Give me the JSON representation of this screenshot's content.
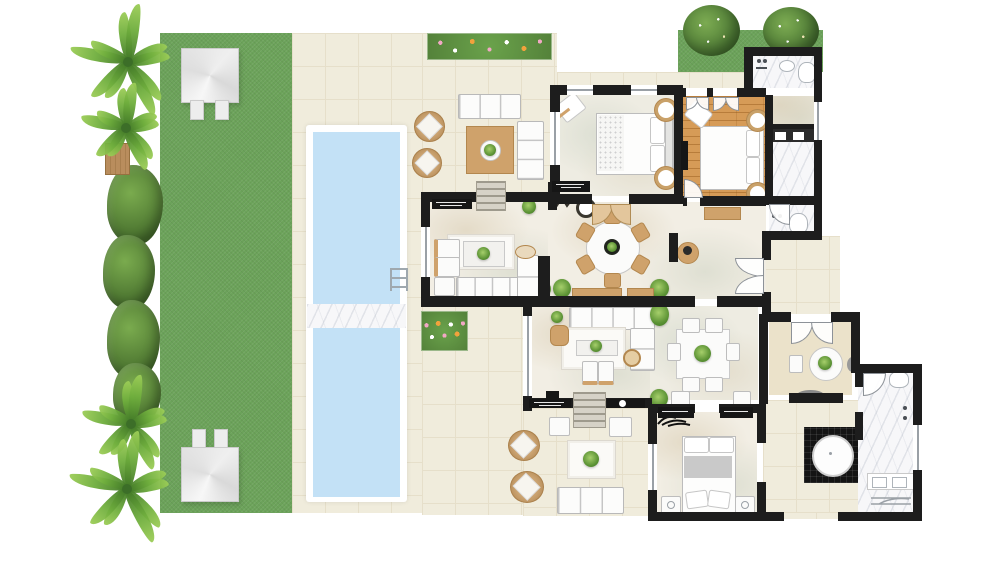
{
  "meta": {
    "kind": "villa floor plan",
    "view": "top-down 2D architectural plan",
    "visible_text": []
  },
  "palette": {
    "wall": "#1d1d1d",
    "lawn": "#6ca35a",
    "terrace": "#f0ecdc",
    "terrace_line": "#e6dfca",
    "interior": "#f2eee4",
    "interior_alt": "#eeece2",
    "wood_floor": "#d69b57",
    "marble": "#f7f7f9",
    "pool_water": "#c3e1f6",
    "tan": "#cfa26b",
    "tan_dark": "#b3874e",
    "white_furniture": "#fcfcfb",
    "furniture_line": "#b9b9b9",
    "black_furniture": "#161616",
    "steps": "#d6d2c7",
    "flower_pink": "#f2a8c5",
    "flower_orange": "#f2a23c",
    "glass_window": "#9aa0a6",
    "tub_black": "#141414"
  },
  "outdoor": {
    "garden": {
      "lawn": "large lawn along the left side",
      "palm_trees": 4,
      "hedge": "leafy hedge along left lawn edge",
      "bench": "wood slat bench on lawn edge",
      "gazebos": [
        {
          "position": "top-left"
        },
        {
          "position": "bottom-left"
        }
      ]
    },
    "pool": {
      "basins": 2,
      "divider": "marble bridge walkway",
      "ladder": "right edge of upper basin"
    },
    "terrace": {
      "flower_beds": 2,
      "upper_lounge": [
        "3-seat outdoor sofa",
        "2-seat outdoor sofa",
        "2 round rattan chairs",
        "square rug with round table and plant"
      ],
      "lower_lounge": [
        "3-seat outdoor sofa",
        "2 round rattan chairs",
        "rug with plant",
        "2 side tables"
      ]
    },
    "grass_patch_top_right": {
      "bushes": 2
    }
  },
  "rooms": [
    {
      "name": "living-room",
      "furniture": [
        "L-shaped white sofa",
        "two armchairs",
        "ottoman",
        "coffee table with plant",
        "white rug",
        "black sideboard",
        "entry steps"
      ]
    },
    {
      "name": "dining-hall",
      "furniture": [
        "round dining table",
        "6 wooden chairs",
        "zigzag runner",
        "round pouf",
        "round side table",
        "2 plants",
        "2 wall benches"
      ]
    },
    {
      "name": "master-bedroom",
      "furniture": [
        "double bed",
        "2 bedside lamps",
        "chaise with cushion",
        "black console",
        "double swing doors"
      ]
    },
    {
      "name": "wood-floor-bedroom",
      "furniture": [
        "double bed",
        "2 bedside lamps",
        "wall TV",
        "two double doors",
        "bench outside wall"
      ]
    },
    {
      "name": "master-bathroom",
      "furniture": [
        "shower",
        "sink",
        "WC"
      ]
    },
    {
      "name": "ensuite-bathroom",
      "furniture": [
        "double vanity"
      ]
    },
    {
      "name": "guest-wc",
      "furniture": [
        "WC",
        "shower"
      ]
    },
    {
      "name": "family-room",
      "furniture": [
        "L-shaped sofa",
        "coffee table",
        "rug",
        "2 ottomans",
        "armchair",
        "basket",
        "media wall with TV",
        "black credenza",
        "steps to terrace"
      ]
    },
    {
      "name": "second-dining-room",
      "furniture": [
        "rectangular table",
        "6 white chairs",
        "plant centerpiece"
      ]
    },
    {
      "name": "breakfast-nook",
      "furniture": [
        "round table with plant",
        "2 chairs",
        "oval rug",
        "double doors"
      ]
    },
    {
      "name": "second-bedroom",
      "furniture": [
        "double bed",
        "2 nightstands",
        "2 desks with chairs",
        "palm wall decor",
        "corner plant"
      ]
    },
    {
      "name": "spa-bathroom",
      "furniture": [
        "round soaking tub on black platform",
        "double vanity",
        "WC",
        "shower",
        "towel rail"
      ]
    }
  ]
}
